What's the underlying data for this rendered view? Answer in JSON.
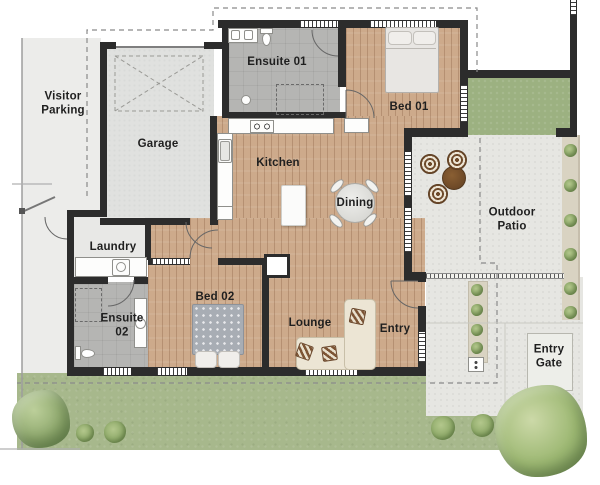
{
  "plan_title": "Single-storey house floor plan",
  "rooms": [
    {
      "name": "visitor-parking",
      "label": "Visitor Parking"
    },
    {
      "name": "garage",
      "label": "Garage"
    },
    {
      "name": "ensuite-01",
      "label": "Ensuite 01"
    },
    {
      "name": "kitchen",
      "label": "Kitchen"
    },
    {
      "name": "dining",
      "label": "Dining"
    },
    {
      "name": "bed-01",
      "label": "Bed 01"
    },
    {
      "name": "outdoor-patio",
      "label": "Outdoor Patio"
    },
    {
      "name": "laundry",
      "label": "Laundry"
    },
    {
      "name": "ensuite-02",
      "label": "Ensuite 02"
    },
    {
      "name": "bed-02",
      "label": "Bed 02"
    },
    {
      "name": "lounge",
      "label": "Lounge"
    },
    {
      "name": "entry",
      "label": "Entry"
    },
    {
      "name": "entry-gate",
      "label": "Entry Gate"
    }
  ],
  "colors": {
    "wall": "#2c2c2c",
    "wood_floor": "#cdaa8b",
    "tile_floor": "#b5b5b3",
    "garage_floor": "#e0e1df",
    "driveway": "#ececea",
    "concrete": "#e6e6e2",
    "lawn": "#a7b88c",
    "tree": "#8fa96e",
    "label_text": "#1f1f1f"
  }
}
